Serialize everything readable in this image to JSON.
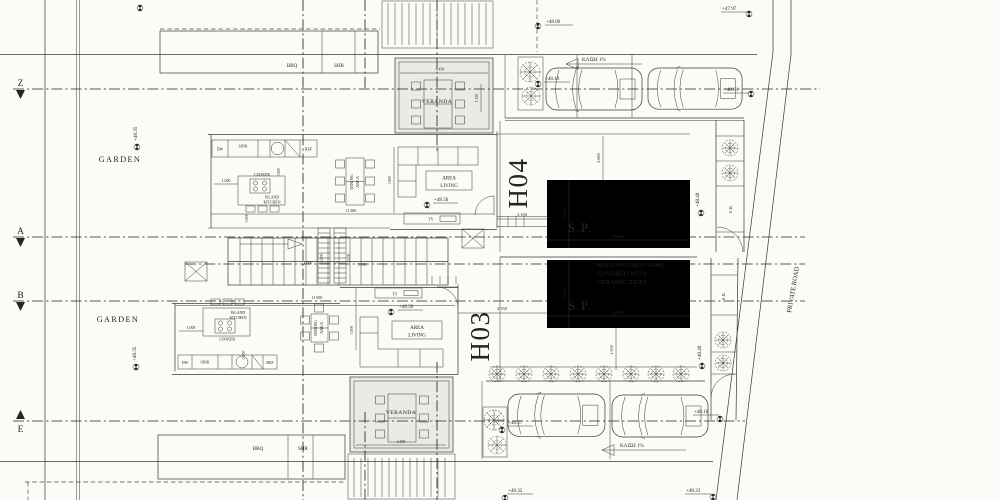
{
  "sheet": {
    "paper_color": "#fbfbf8",
    "ink_color": "#27251f"
  },
  "grid_axes": [
    {
      "label": "Z"
    },
    {
      "label": "A"
    },
    {
      "label": "B"
    },
    {
      "label": "E"
    }
  ],
  "houses": [
    {
      "label": "H04"
    },
    {
      "label": "H03"
    }
  ],
  "areas": {
    "garden": "GARDEN",
    "veranda": "VERANDA",
    "bbq": "BBQ",
    "shower": "SHR",
    "living_1": "AREA",
    "living_2": "LIVING",
    "dining_1": "DINING",
    "dining_2": "AREA",
    "island_1": "ISLAND",
    "island_2": "KITCHEN",
    "cooker": "COOKER",
    "dishwasher": "DW",
    "sink": "SINK",
    "fridge": "REF",
    "tv": "TV",
    "pool": "S.P.",
    "engine_room": "E.R.",
    "private_road": "PRIVATE ROAD"
  },
  "notes": {
    "wall_1": "WALL H=2.0M (+50.40)",
    "wall_2": "COVERED WITH",
    "wall_3": "CERAMIC TILES",
    "slope": "ΚΛΙΣΗ 1%"
  },
  "levels": {
    "l4797": "+47.97",
    "l4801": "+48.01",
    "l4806": "+48.06",
    "l4810": "+48.10",
    "l4818": "+48.18",
    "l4823": "+48.23",
    "l4827": "+48.27",
    "l4832": "+48.32",
    "l4835": "+48.35",
    "l4840": "+48.40",
    "l4850": "+48.50"
  },
  "dims": {
    "d0900": "0.900",
    "d1000": "1.000",
    "d1350": "1.350",
    "d1500": "1.500",
    "d2000": "2.000",
    "d2100": "2.100",
    "d2695": "2.695",
    "d3000": "3.000",
    "d3550": "3.550",
    "d3900": "3.900",
    "d4450": "4.450",
    "d5180": "5.180",
    "d6000": "6.000",
    "d11380": "11.380",
    "d11690": "11.690"
  }
}
